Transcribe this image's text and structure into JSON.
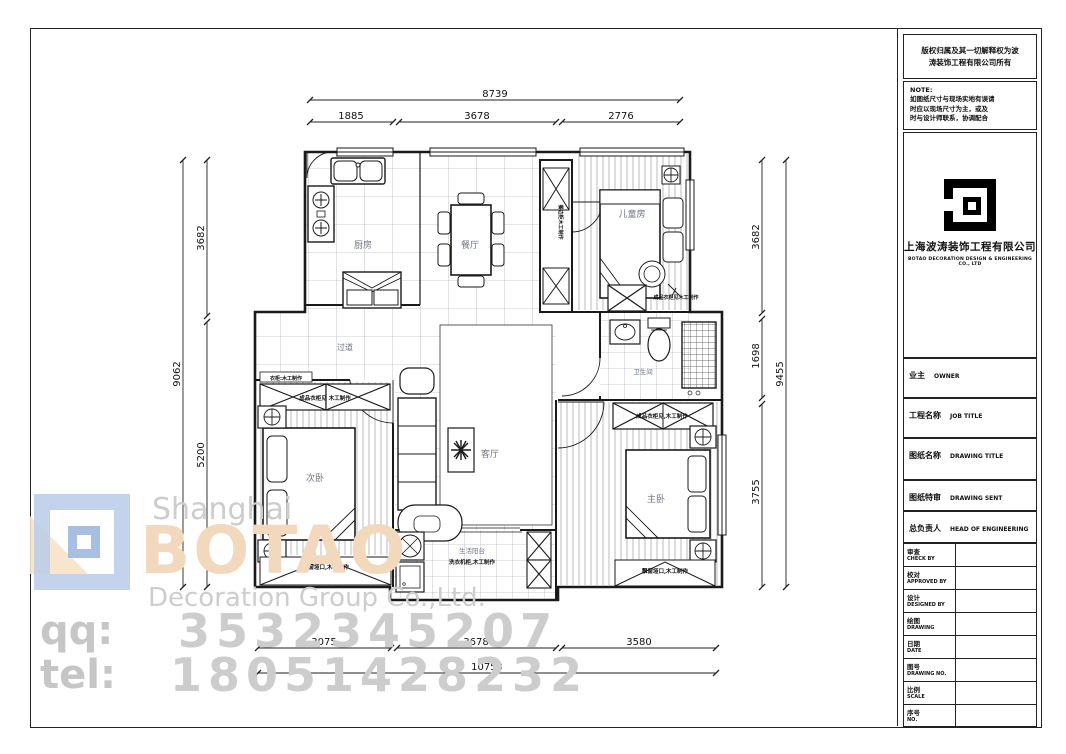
{
  "title_block": {
    "copyright_line1": "版权归属及其一切解释权为波",
    "copyright_line2": "涛装饰工程有限公司所有",
    "note": {
      "title": "NOTE:",
      "line1": "如图纸尺寸与现场实地有误请",
      "line2": "时应以现场尺寸为主，或及",
      "line3": "时与设计师联系，协调配合"
    },
    "company": {
      "name_cn": "上海波涛装饰工程有限公司",
      "name_en": "BOTAO DECORATION DESIGN & ENGINEERING CO., LTD"
    },
    "fields": [
      {
        "cn": "业主",
        "en": "OWNER"
      },
      {
        "cn": "工程名称",
        "en": "JOB TITLE"
      },
      {
        "cn": "图纸名称",
        "en": "DRAWING TITLE"
      },
      {
        "cn": "图纸特审",
        "en": "DRAWING SENT"
      },
      {
        "cn": "总负责人",
        "en": "HEAD OF ENGINEERING"
      }
    ],
    "table_rows": [
      {
        "cn": "审查",
        "en": "CHECK BY",
        "value": ""
      },
      {
        "cn": "校对",
        "en": "APPROVED BY",
        "value": ""
      },
      {
        "cn": "设计",
        "en": "DESIGNED BY",
        "value": ""
      },
      {
        "cn": "绘图",
        "en": "DRAWING",
        "value": ""
      },
      {
        "cn": "日期",
        "en": "DATE",
        "value": ""
      },
      {
        "cn": "图号",
        "en": "DRAWING NO.",
        "value": ""
      },
      {
        "cn": "比例",
        "en": "SCALE",
        "value": ""
      },
      {
        "cn": "序号",
        "en": "NO.",
        "value": ""
      }
    ]
  },
  "watermark": {
    "line1": "Shanghai",
    "line2": "BOTAO",
    "line3": "Decoration Group Co.,Ltd.",
    "qq_label": "qq:",
    "qq_number": "3532345207",
    "tel_label": "tel:",
    "tel_number": "18051428232"
  },
  "plan": {
    "rooms": {
      "kitchen": "厨房",
      "dining": "餐厅",
      "kids": "儿童房",
      "hall": "过道",
      "second": "次卧",
      "living": "客厅",
      "bath": "卫生间",
      "master": "主卧",
      "laundry": "生活阳台"
    },
    "notes": {
      "kids_wardrobe": "成品衣柜见木工制作",
      "hall_cabinet_tag": "衣柜:木工制作",
      "hall_wardrobe": "成品衣柜见 木工制作",
      "left_bay": "飘窗垭口,木工制作",
      "master_wardrobe": "成品衣柜见,木工制作",
      "master_bay": "飘窗垭口,木工制作",
      "laundry_cabinet": "洗衣机柜,木工制作",
      "sideboard": "餐边柜木工制作"
    },
    "dims": {
      "top": {
        "overall": "8739",
        "s1": "1885",
        "s2": "3678",
        "s3": "2776"
      },
      "bottom": {
        "overall": "10753",
        "s1": "3075",
        "s2": "3678",
        "s3": "3580"
      },
      "left": {
        "overall": "9062",
        "s1": "3682",
        "s2": "5200"
      },
      "right": {
        "overall": "9455",
        "s1": "3682",
        "s2": "1698",
        "s3": "3755"
      }
    }
  },
  "colors": {
    "line_black": "#1a1a1a",
    "watermark_gray": "#cdcdcd",
    "watermark_tan": "#f2d9bd",
    "logo_blue": "#b9cbe8"
  }
}
